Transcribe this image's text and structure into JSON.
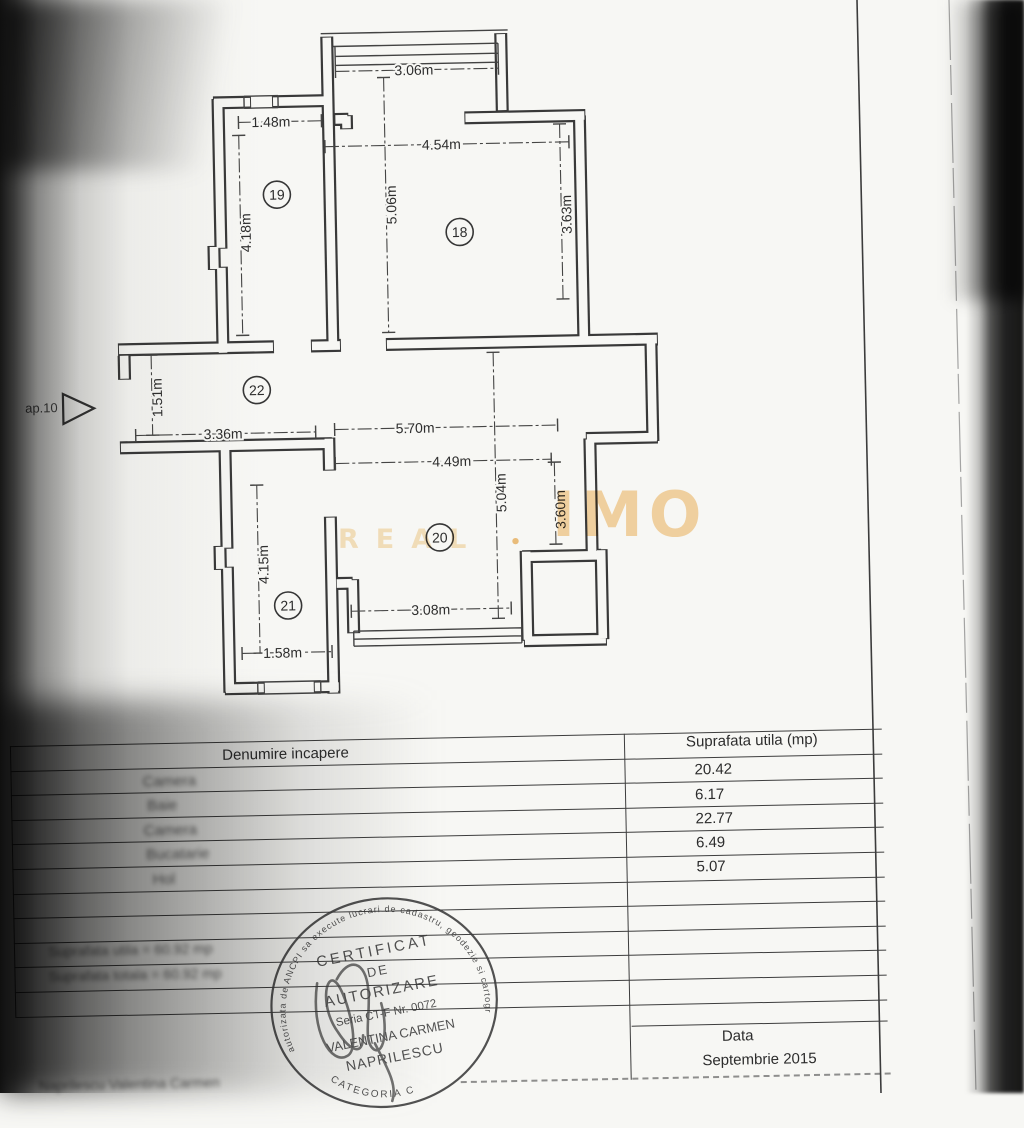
{
  "plan": {
    "dims": [
      "3.06m",
      "1.48m",
      "4.54m",
      "5.06m",
      "4.18m",
      "3.63m",
      "1.51m",
      "3.36m",
      "5.70m",
      "4.49m",
      "5.04m",
      "3.60m",
      "4.15m",
      "1.58m",
      "3.08m"
    ],
    "rooms": [
      "18",
      "19",
      "20",
      "21",
      "22"
    ],
    "entry_label": "ap.10"
  },
  "watermark": {
    "line1": "IMO",
    "line2": "REAL",
    "dot": "•"
  },
  "table": {
    "header": {
      "col1": "Denumire incapere",
      "col2": "Suprafata utila (mp)"
    },
    "rows": [
      {
        "name": "Camera",
        "area": "20.42"
      },
      {
        "name": "Baie",
        "area": "6.17"
      },
      {
        "name": "Camera",
        "area": "22.77"
      },
      {
        "name": "Bucatarie",
        "area": "6.49"
      },
      {
        "name": "Hol",
        "area": "5.07"
      }
    ],
    "summary": [
      "Suprafata utila = 60.92 mp",
      "Suprafata totala = 60.92 mp"
    ],
    "date_label": "Data",
    "date_value": "Septembrie 2015",
    "signature_note": "Naprilescu Valentina Carmen"
  },
  "stamp": {
    "arc_top": "autorizata de ANCPI sa execute lucrari de cadastru, geodezie si cartografie",
    "line1": "CERTIFICAT",
    "line2": "DE",
    "line3": "AUTORIZARE",
    "line4": "Seria CT-F Nr. 0072",
    "line5": "VALENTINA CARMEN",
    "line6": "NAPRILESCU",
    "arc_bottom": "CATEGORIA C"
  }
}
